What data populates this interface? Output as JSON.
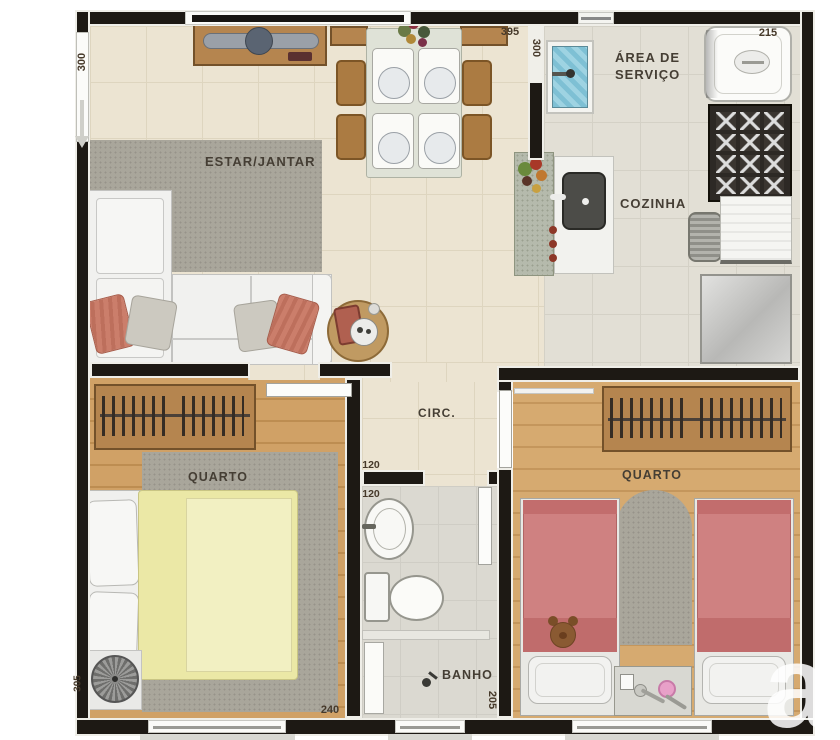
{
  "plan": {
    "watermark": "a",
    "rooms": {
      "living": "ESTAR/JANTAR",
      "service_line1": "ÁREA DE",
      "service_line2": "SERVIÇO",
      "kitchen": "COZINHA",
      "hall": "CIRC.",
      "bedroom_left": "QUARTO",
      "bedroom_right": "QUARTO",
      "bath": "BANHO"
    },
    "dimensions": {
      "living_window": "300",
      "living_width": "395",
      "service_wall": "300",
      "service_width": "215",
      "hall_width": "120",
      "bath_door": "120",
      "bedroom_left_width": "240",
      "bath_length": "205",
      "bedroom_left_window": "305"
    },
    "palette": {
      "wall": "#1d1914",
      "floor_tile": "#ece4d2",
      "floor_kitchen": "#e2dfd5",
      "floor_wood": "#d0a166",
      "rug": "#a9a69b",
      "bed_yellow": "#ebe8a6",
      "bed_pink": "#cf8181",
      "laundry_blue": "#8ec7d6"
    }
  }
}
